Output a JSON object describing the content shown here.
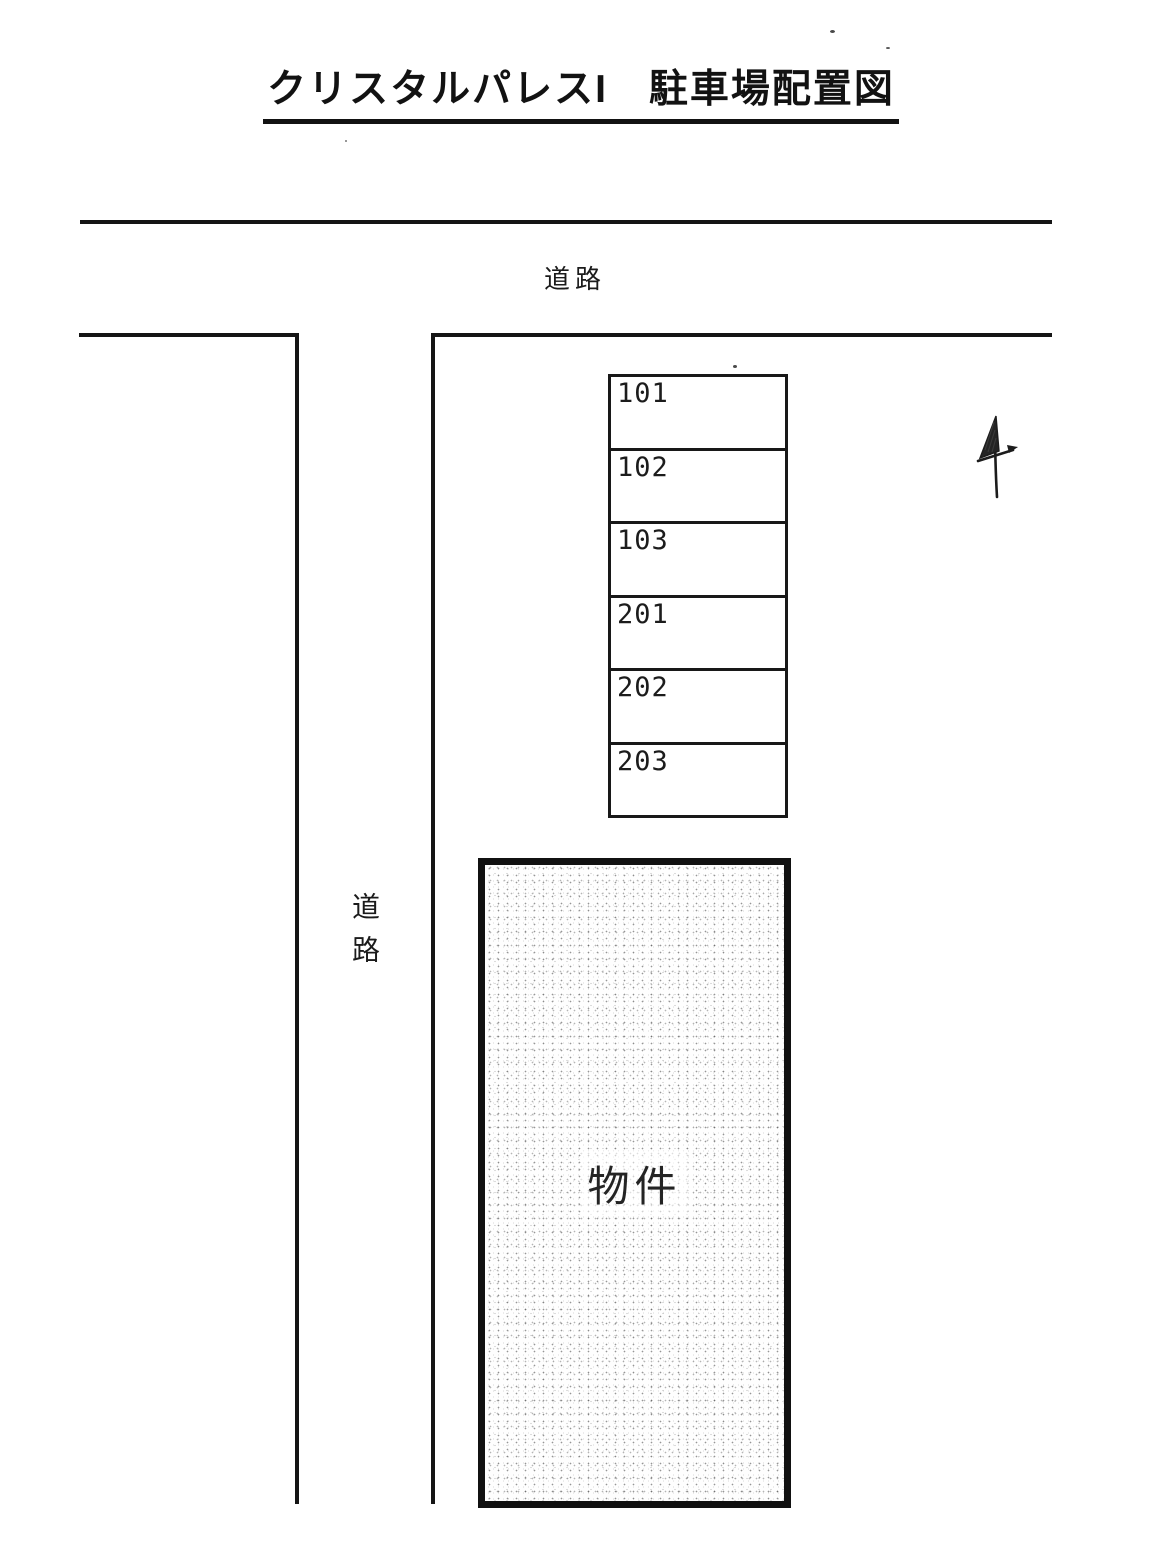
{
  "document": {
    "title": "クリスタルパレスI　駐車場配置図"
  },
  "roads": {
    "top": {
      "label": "道路"
    },
    "left": {
      "label": "道路"
    }
  },
  "parking_lot": {
    "stalls": [
      {
        "id": "101"
      },
      {
        "id": "102"
      },
      {
        "id": "103"
      },
      {
        "id": "201"
      },
      {
        "id": "202"
      },
      {
        "id": "203"
      }
    ]
  },
  "building": {
    "label": "物件"
  },
  "annotations": {
    "north_arrow": "hand-drawn arrow mark"
  },
  "colors": {
    "paper": "#ffffff",
    "ink": "#161616"
  }
}
